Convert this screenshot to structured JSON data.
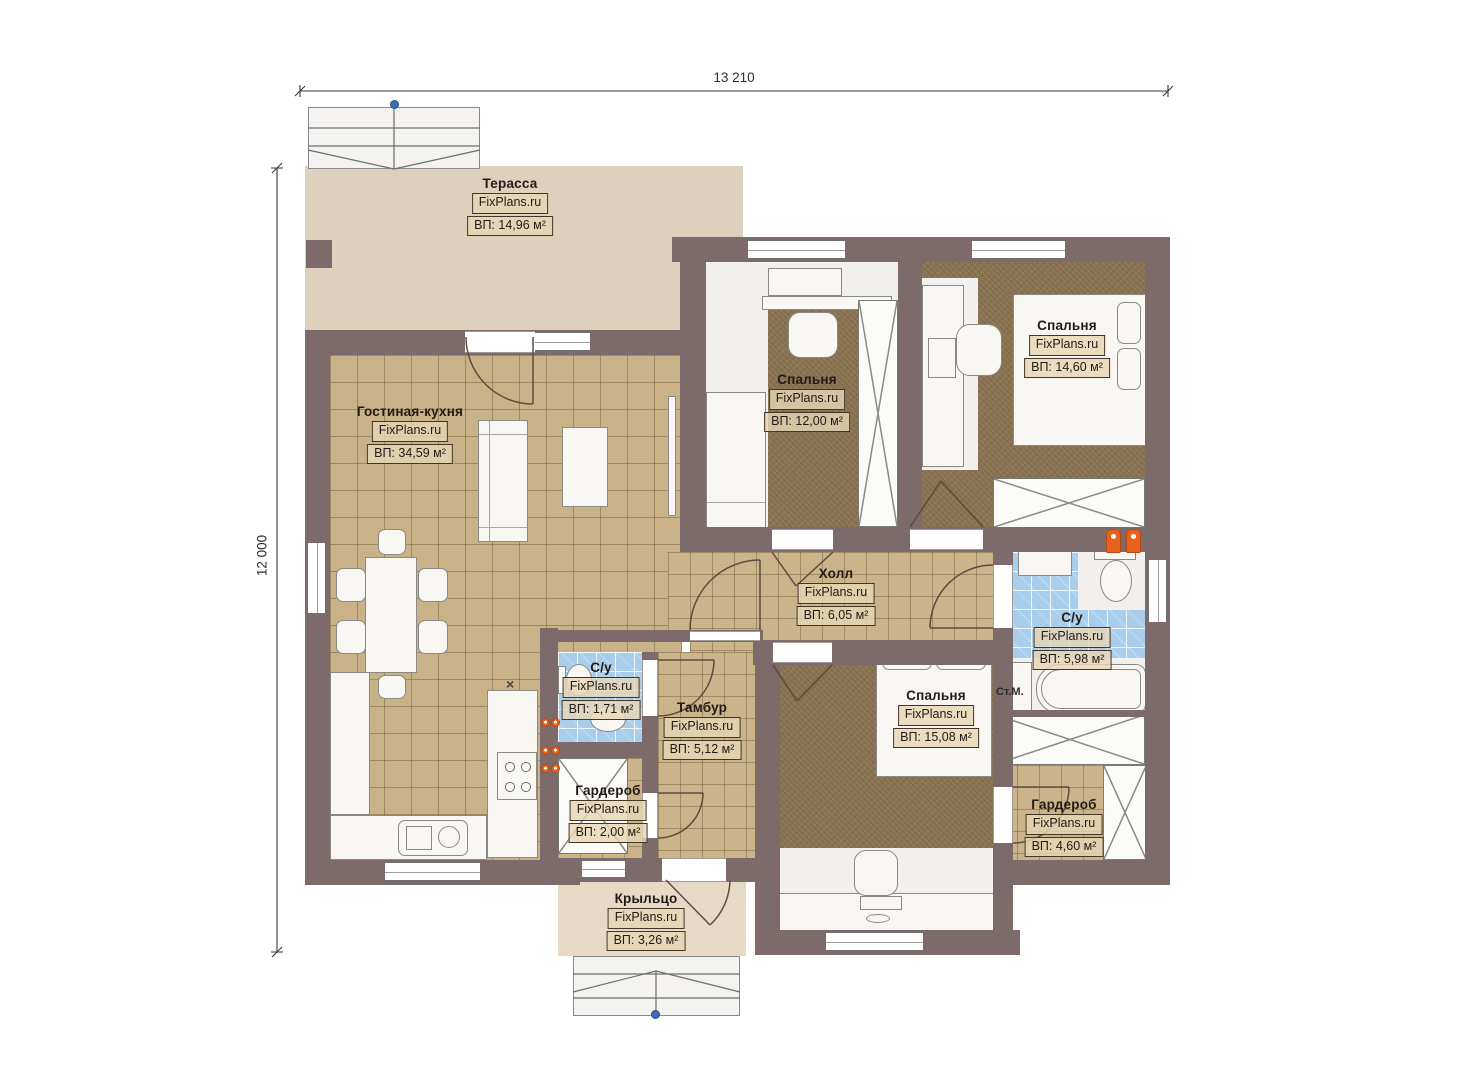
{
  "plan": {
    "brand": "FixPlans.ru",
    "dims": {
      "width": "13 210",
      "height": "12 000"
    },
    "rooms": {
      "terrace": {
        "name": "Терасса",
        "area": "ВП: 14,96 м²"
      },
      "living": {
        "name": "Гостиная-кухня",
        "area": "ВП: 34,59 м²"
      },
      "bedroom1": {
        "name": "Спальня",
        "area": "ВП: 12,00 м²"
      },
      "bedroom2": {
        "name": "Спальня",
        "area": "ВП: 14,60 м²"
      },
      "hall": {
        "name": "Холл",
        "area": "ВП: 6,05 м²"
      },
      "bathroom": {
        "name": "С/у",
        "area": "ВП: 5,98 м²"
      },
      "wc": {
        "name": "С/у",
        "area": "ВП: 1,71 м²"
      },
      "tambour": {
        "name": "Тамбур",
        "area": "ВП: 5,12 м²"
      },
      "wardrobe1": {
        "name": "Гардероб",
        "area": "ВП: 2,00 м²"
      },
      "bedroom3": {
        "name": "Спальня",
        "area": "ВП: 15,08 м²"
      },
      "wardrobe2": {
        "name": "Гардероб",
        "area": "ВП: 4,60 м²"
      },
      "porch": {
        "name": "Крыльцо",
        "area": "ВП: 3,26 м²"
      }
    },
    "annotations": {
      "washer": "Ст.М.",
      "vent": "×"
    }
  }
}
